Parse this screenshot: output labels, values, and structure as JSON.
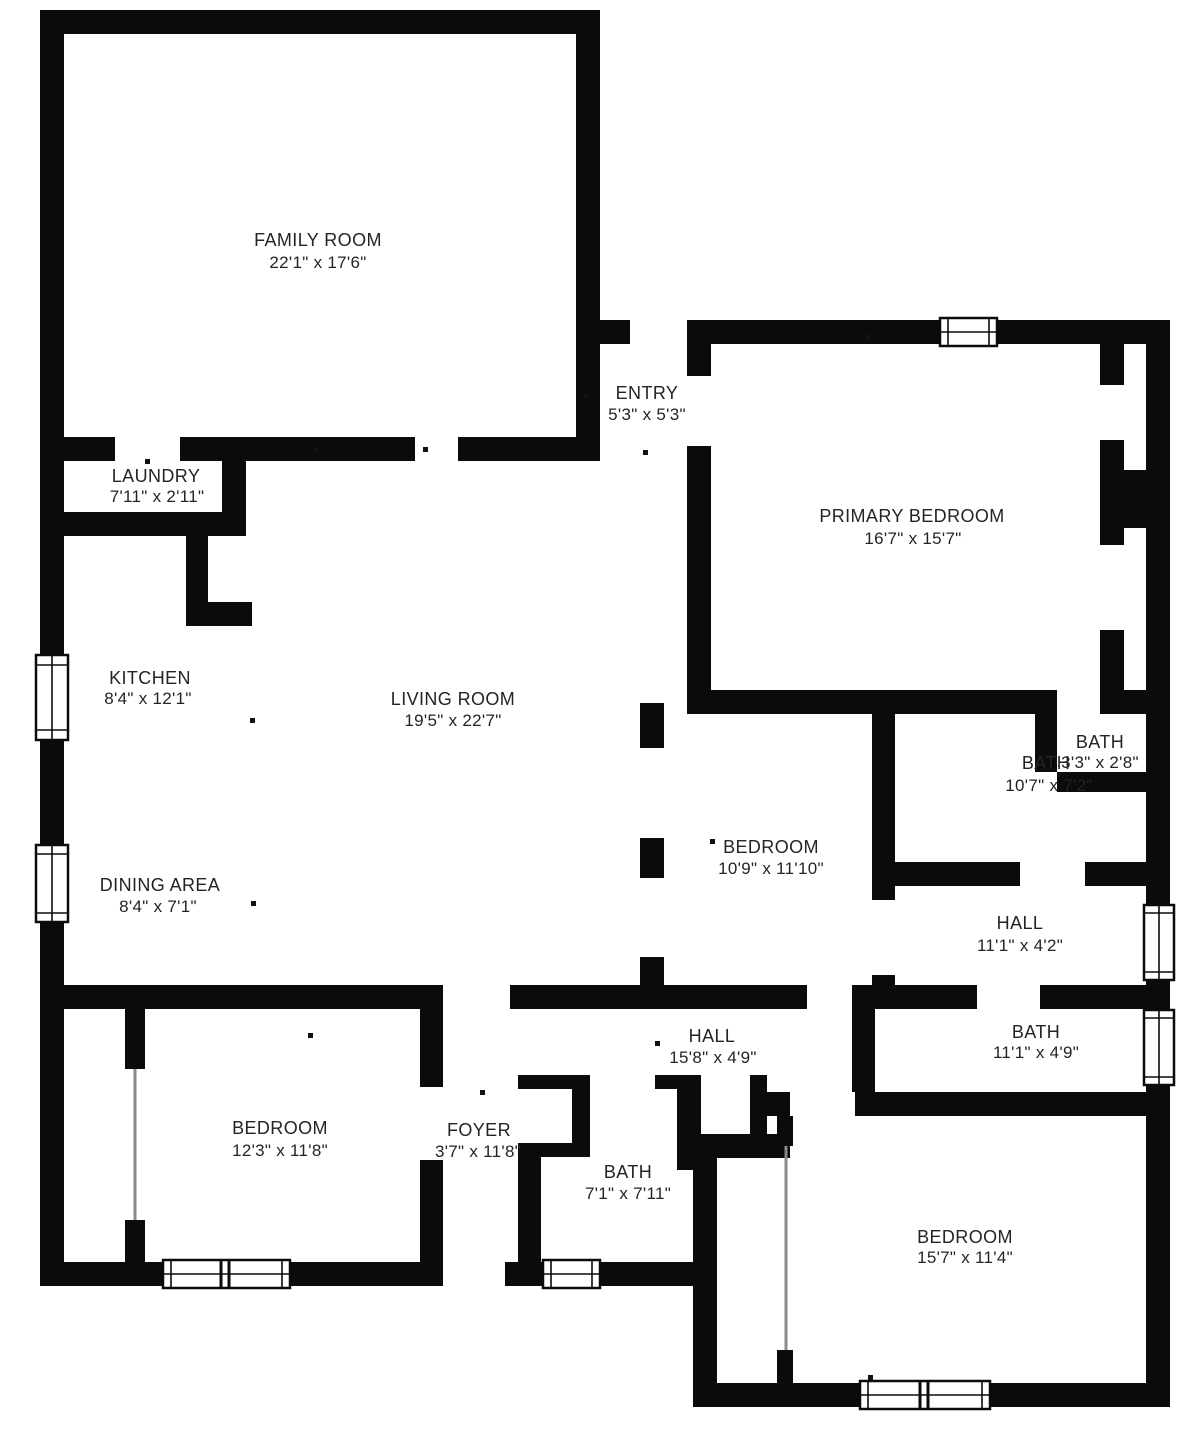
{
  "page": {
    "background_color": "#ffffff",
    "wall_color": "#0b0b0b",
    "label_color": "#242424",
    "type": "floor-plan"
  },
  "floor_plan": {
    "rooms": [
      {
        "id": "family-room",
        "name": "FAMILY ROOM",
        "dims": "22'1\" x 17'6\""
      },
      {
        "id": "entry",
        "name": "ENTRY",
        "dims": "5'3\" x 5'3\""
      },
      {
        "id": "laundry",
        "name": "LAUNDRY",
        "dims": "7'11\" x 2'11\""
      },
      {
        "id": "primary-bedroom",
        "name": "PRIMARY BEDROOM",
        "dims": "16'7\" x 15'7\""
      },
      {
        "id": "kitchen",
        "name": "KITCHEN",
        "dims": "8'4\" x 12'1\""
      },
      {
        "id": "living-room",
        "name": "LIVING ROOM",
        "dims": "19'5\" x 22'7\""
      },
      {
        "id": "bath-small",
        "name": "BATH",
        "dims": "3'3\" x 2'8\""
      },
      {
        "id": "bath-ensuite",
        "name": "BATH",
        "dims": "10'7\" x 7'2\""
      },
      {
        "id": "bedroom-middle",
        "name": "BEDROOM",
        "dims": "10'9\" x 11'10\""
      },
      {
        "id": "dining-area",
        "name": "DINING AREA",
        "dims": "8'4\" x 7'1\""
      },
      {
        "id": "hall-right",
        "name": "HALL",
        "dims": "11'1\" x 4'2\""
      },
      {
        "id": "hall-center",
        "name": "HALL",
        "dims": "15'8\" x 4'9\""
      },
      {
        "id": "bath-hall",
        "name": "BATH",
        "dims": "11'1\" x 4'9\""
      },
      {
        "id": "bedroom-left",
        "name": "BEDROOM",
        "dims": "12'3\" x 11'8\""
      },
      {
        "id": "foyer",
        "name": "FOYER",
        "dims": "3'7\" x 11'8\""
      },
      {
        "id": "bath-center",
        "name": "BATH",
        "dims": "7'1\" x 7'11\""
      },
      {
        "id": "bedroom-right",
        "name": "BEDROOM",
        "dims": "15'7\" x 11'4\""
      }
    ]
  }
}
